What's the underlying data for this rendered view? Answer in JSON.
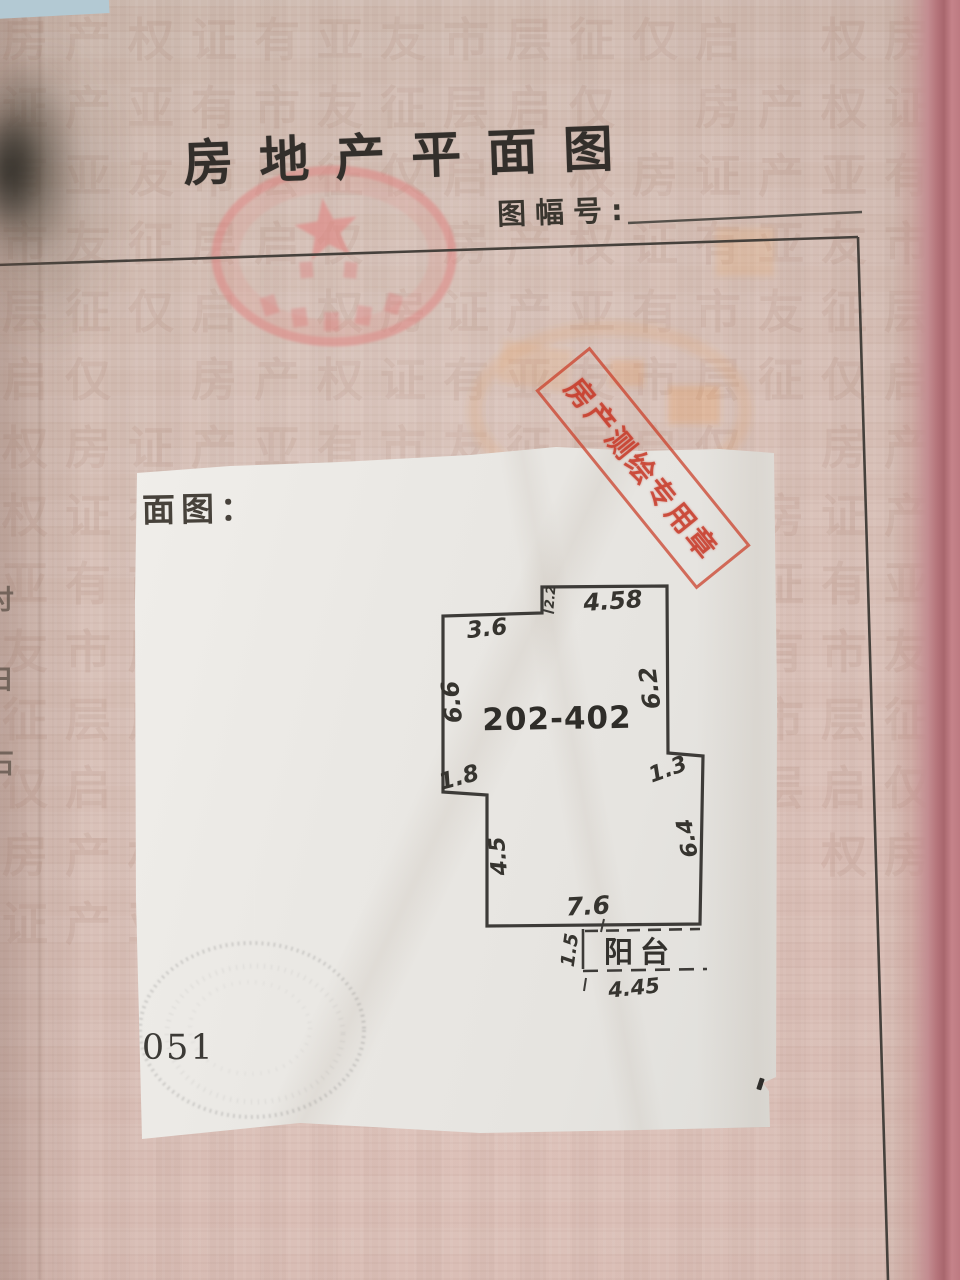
{
  "header": {
    "title": "房地产平面图",
    "sheet_no_label": "图幅号:",
    "sheet_no_value": ""
  },
  "page": {
    "plan_caption": "平面图：",
    "doc_number": "-051",
    "margin_chars": {
      "c1": "付",
      "c2": "日",
      "c3": "石"
    }
  },
  "floor_plan": {
    "unit": "202-402",
    "balcony": "阳台",
    "dims": {
      "top": "4.58",
      "top_notch": "2.2",
      "upper_left": "3.6",
      "left": "6.6",
      "right_upper": "6.2",
      "right_step": "1.3",
      "right_lower": "6.4",
      "mid_left": "4.5",
      "left_step": "1.8",
      "bottom": "7.6",
      "balcony_depth": "1.5",
      "balcony_width": "4.45"
    }
  },
  "stamps": {
    "rect_text": "房产测绘专用章"
  },
  "colors": {
    "stamp_red": "#cb3c26",
    "page_pink": "#d8bfb5",
    "paper_white": "#eceae6",
    "ink": "#36342f"
  },
  "watermark": {
    "text": "房产权证有亚友市层征仅启　权房证产亚有市友征层启仅　房产权证有亚友市层征仅启　权房证产亚有市友征层启仅　房产权证有亚友市层征仅启　权房证产亚有市友征层启仅　房产权证有亚友市层征仅启　权房证产亚有市友征层启仅　房产权证有亚友市层征仅启　权房证产亚有市友征层启仅　房产权证有亚友市层征仅启　权房证产亚有市友征层启仅　房产权证有亚友市层征仅启　权房证产亚有市友征层启仅　房产权证有亚友市层征仅启　权房证产亚有市友征层启仅"
  }
}
